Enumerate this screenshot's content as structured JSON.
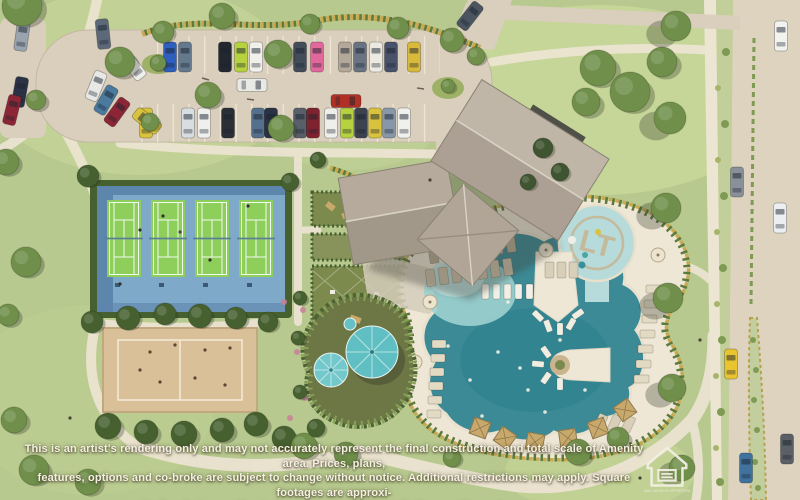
{
  "disclaimer": {
    "line1": "This is an artist's rendering only and may not accurately represent the final construction and total scale of Amenity area. Prices, plans,",
    "line2": "features, options and co-broke are subject to change without notice. Additional restrictions may apply. Square footages are approxi-",
    "line3": "mate. Rendering applies to the Lonestar at Liberty Trails amenity center only."
  },
  "logo": {
    "name": "equal-housing-opportunity-logo",
    "caption": "EQUAL HOUSING OPPORTUNITY"
  },
  "splash_pad": {
    "monogram": "LT"
  },
  "palette": {
    "grass": "#b7c98e",
    "lawn_light": "#c6d69b",
    "path": "#ebe3d0",
    "asphalt": "#d9cfbc",
    "road": "#ddd3bf",
    "sidewalk": "#ece5d2",
    "tennis_blue": "#7fa9c9",
    "tennis_blue_dark": "#5d86ad",
    "court_green": "#8ecf5c",
    "sand": "#d9c098",
    "hedge_dark": "#46602f",
    "tree_mid": "#6f8f4a",
    "roof_light": "#bcb1a2",
    "roof_dark": "#a2978a",
    "pool_deep": "#2e8694",
    "pool_shallow": "#9ed0cf",
    "splash": "#b7dada",
    "deck": "#efe7d6",
    "umbrella_teal": "#5fbfc3",
    "cabana_tan": "#c9a96b",
    "scallop_tan": "#c9aa52",
    "scallop_green": "#5d7a3c",
    "playground_surface": "#6d7745",
    "monogram_tan": "#c7b28c",
    "flower_pink": "#c97f9a",
    "text_cream": "#f4f0e2"
  },
  "scene": {
    "tennis": {
      "court_x": [
        107,
        151,
        195,
        239
      ],
      "y": 200,
      "w": 34,
      "h": 77
    },
    "cars": {
      "parking_top_row": {
        "y": 57,
        "items": [
          {
            "x": 170,
            "color": "#2f5fbe"
          },
          {
            "x": 185,
            "color": "#64788e"
          },
          {
            "x": 225,
            "color": "#23272e"
          },
          {
            "x": 241,
            "color": "#b6d23e"
          },
          {
            "x": 256,
            "color": "#f1f1ec"
          },
          {
            "x": 300,
            "color": "#454c59"
          },
          {
            "x": 317,
            "color": "#e2679b"
          },
          {
            "x": 345,
            "color": "#b3a89a"
          },
          {
            "x": 360,
            "color": "#6a7382"
          },
          {
            "x": 376,
            "color": "#ebe9e1"
          },
          {
            "x": 391,
            "color": "#49526b"
          },
          {
            "x": 414,
            "color": "#d9b93a"
          }
        ]
      },
      "parking_bottom_row": {
        "y": 123,
        "items": [
          {
            "x": 146,
            "color": "#d9c23c"
          },
          {
            "x": 188,
            "color": "#d8dde2"
          },
          {
            "x": 204,
            "color": "#eff0ee"
          },
          {
            "x": 228,
            "color": "#2b2f36"
          },
          {
            "x": 258,
            "color": "#54708c"
          },
          {
            "x": 271,
            "color": "#2c3246"
          },
          {
            "x": 300,
            "color": "#585f68"
          },
          {
            "x": 313,
            "color": "#7e222e"
          },
          {
            "x": 331,
            "color": "#eeeeea"
          },
          {
            "x": 347,
            "color": "#b6d23e"
          },
          {
            "x": 361,
            "color": "#3d434e"
          },
          {
            "x": 375,
            "color": "#d9c23c"
          },
          {
            "x": 389,
            "color": "#8897a8"
          },
          {
            "x": 404,
            "color": "#f0f0ec"
          }
        ]
      },
      "free": [
        {
          "x": 22,
          "y": 36,
          "rot": 8,
          "color": "#9aa4ae"
        },
        {
          "x": 103,
          "y": 34,
          "rot": -6,
          "color": "#5d6878"
        },
        {
          "x": 133,
          "y": 66,
          "rot": -38,
          "color": "#eff0ec"
        },
        {
          "x": 96,
          "y": 86,
          "rot": 22,
          "color": "#e8e9e6"
        },
        {
          "x": 106,
          "y": 100,
          "rot": 30,
          "color": "#4a7a9e"
        },
        {
          "x": 117,
          "y": 112,
          "rot": 36,
          "color": "#8c2636"
        },
        {
          "x": 20,
          "y": 92,
          "rot": 10,
          "color": "#2c3246"
        },
        {
          "x": 12,
          "y": 110,
          "rot": 14,
          "color": "#8c2636"
        },
        {
          "x": 147,
          "y": 121,
          "rot": -52,
          "color": "#d9c23c"
        },
        {
          "x": 252,
          "y": 85,
          "rot": 90,
          "color": "#e9eae6"
        },
        {
          "x": 346,
          "y": 101,
          "rot": 90,
          "color": "#b03026"
        },
        {
          "x": 470,
          "y": 16,
          "rot": 38,
          "color": "#4b5560"
        }
      ],
      "road": [
        {
          "x": 781,
          "y": 36,
          "color": "#f2f2ee"
        },
        {
          "x": 737,
          "y": 182,
          "color": "#8a9099"
        },
        {
          "x": 780,
          "y": 218,
          "color": "#eceff2"
        },
        {
          "x": 731,
          "y": 364,
          "color": "#e8c52e"
        },
        {
          "x": 746,
          "y": 468,
          "color": "#3f739e"
        },
        {
          "x": 787,
          "y": 449,
          "color": "#5a6066"
        }
      ]
    },
    "trees": [
      [
        22,
        6,
        20,
        "m",
        4,
        4
      ],
      [
        120,
        62,
        15,
        "m",
        4,
        4
      ],
      [
        222,
        16,
        13,
        "m",
        3,
        3
      ],
      [
        208,
        95,
        13,
        "m",
        3,
        3
      ],
      [
        36,
        100,
        10,
        "m",
        3,
        3
      ],
      [
        163,
        32,
        11,
        "m",
        2,
        2
      ],
      [
        278,
        54,
        14,
        "m",
        3,
        3
      ],
      [
        281,
        128,
        13,
        "m",
        3,
        3
      ],
      [
        150,
        122,
        9,
        "m",
        2,
        2
      ],
      [
        310,
        24,
        10,
        "m",
        2,
        2
      ],
      [
        398,
        28,
        11,
        "m",
        2,
        2
      ],
      [
        452,
        40,
        12,
        "m",
        3,
        3
      ],
      [
        476,
        56,
        9,
        "m",
        2,
        2
      ],
      [
        158,
        63,
        8,
        "m",
        2,
        2
      ],
      [
        448,
        86,
        7,
        "m",
        2,
        2
      ],
      [
        6,
        162,
        13,
        "m",
        3,
        3
      ],
      [
        26,
        262,
        15,
        "m",
        3,
        3
      ],
      [
        8,
        315,
        11,
        "m",
        3,
        3
      ],
      [
        14,
        420,
        13,
        "m",
        3,
        3
      ],
      [
        34,
        470,
        15,
        "m",
        3,
        3
      ],
      [
        88,
        482,
        13,
        "m",
        3,
        3
      ],
      [
        92,
        322,
        11,
        "d",
        2,
        2
      ],
      [
        128,
        318,
        12,
        "d",
        2,
        2
      ],
      [
        165,
        314,
        11,
        "d",
        2,
        2
      ],
      [
        200,
        316,
        12,
        "d",
        2,
        2
      ],
      [
        236,
        318,
        11,
        "d",
        2,
        2
      ],
      [
        268,
        322,
        10,
        "d",
        2,
        2
      ],
      [
        108,
        426,
        13,
        "d",
        3,
        3
      ],
      [
        146,
        432,
        12,
        "d",
        3,
        3
      ],
      [
        184,
        434,
        13,
        "d",
        3,
        3
      ],
      [
        222,
        430,
        12,
        "d",
        3,
        3
      ],
      [
        256,
        424,
        12,
        "d",
        3,
        3
      ],
      [
        284,
        438,
        12,
        "d",
        3,
        3
      ],
      [
        88,
        176,
        11,
        "d",
        2,
        2
      ],
      [
        290,
        182,
        9,
        "d",
        2,
        2
      ],
      [
        304,
        446,
        13,
        "m",
        3,
        3
      ],
      [
        346,
        454,
        12,
        "m",
        3,
        3
      ],
      [
        598,
        68,
        18,
        "m",
        4,
        4
      ],
      [
        630,
        92,
        20,
        "m",
        4,
        4
      ],
      [
        662,
        62,
        15,
        "m",
        4,
        4
      ],
      [
        586,
        102,
        14,
        "m",
        4,
        4
      ],
      [
        543,
        148,
        10,
        "x",
        2,
        2
      ],
      [
        560,
        172,
        9,
        "x",
        2,
        2
      ],
      [
        528,
        182,
        8,
        "x",
        2,
        2
      ],
      [
        676,
        26,
        15,
        "m",
        -14,
        8
      ],
      [
        670,
        118,
        16,
        "m",
        -14,
        8
      ],
      [
        666,
        208,
        15,
        "m",
        -14,
        8
      ],
      [
        668,
        298,
        15,
        "m",
        -13,
        8
      ],
      [
        672,
        388,
        14,
        "m",
        -12,
        7
      ],
      [
        682,
        468,
        13,
        "m",
        -10,
        6
      ],
      [
        578,
        452,
        13,
        "m",
        3,
        3
      ],
      [
        618,
        438,
        11,
        "m",
        3,
        3
      ],
      [
        452,
        458,
        9,
        "m",
        2,
        2
      ],
      [
        318,
        160,
        8,
        "d",
        2,
        2
      ],
      [
        300,
        298,
        7,
        "d",
        2,
        2
      ],
      [
        298,
        338,
        7,
        "d",
        2,
        2
      ],
      [
        300,
        392,
        7,
        "d",
        2,
        2
      ],
      [
        316,
        428,
        9,
        "d",
        2,
        2
      ]
    ],
    "shrub_dots": [
      [
        719,
        22,
        3
      ],
      [
        726,
        52,
        4
      ],
      [
        718,
        88,
        3
      ],
      [
        725,
        124,
        4
      ],
      [
        718,
        160,
        3
      ],
      [
        724,
        196,
        4
      ],
      [
        717,
        232,
        3
      ],
      [
        723,
        268,
        4
      ],
      [
        717,
        304,
        3
      ],
      [
        722,
        340,
        4
      ],
      [
        716,
        376,
        3
      ],
      [
        721,
        412,
        4
      ],
      [
        716,
        448,
        3
      ],
      [
        720,
        482,
        4
      ]
    ],
    "median_dots": [
      [
        753,
        340,
        3
      ],
      [
        756,
        370,
        3
      ],
      [
        754,
        400,
        3
      ],
      [
        757,
        430,
        3
      ],
      [
        755,
        462,
        3
      ],
      [
        758,
        488,
        3
      ]
    ],
    "lounger_rows": [
      {
        "x": 428,
        "y": 247,
        "count": 7,
        "dx": 13,
        "dy": 0,
        "w": 9,
        "h": 17,
        "rot": -8,
        "color": "#b9ac93"
      },
      {
        "x": 425,
        "y": 270,
        "count": 7,
        "dx": 13,
        "dy": 0,
        "w": 9,
        "h": 17,
        "rot": -8,
        "color": "#cfc3ab"
      },
      {
        "x": 482,
        "y": 284,
        "count": 5,
        "dx": 11,
        "dy": 0,
        "w": 7,
        "h": 15,
        "rot": 0,
        "color": "#f2efe6"
      },
      {
        "x": 646,
        "y": 285,
        "count": 7,
        "dx": -2,
        "dy": 15,
        "w": 15,
        "h": 8,
        "rot": 0,
        "color": "#e3dac4"
      },
      {
        "x": 432,
        "y": 340,
        "count": 6,
        "dx": -1,
        "dy": 14,
        "w": 14,
        "h": 8,
        "rot": 0,
        "color": "#e3dac4"
      },
      {
        "x": 545,
        "y": 262,
        "count": 3,
        "dx": 12,
        "dy": 0,
        "w": 9,
        "h": 16,
        "rot": 0,
        "color": "#d9cfb8"
      },
      {
        "x": 600,
        "y": 413,
        "count": 3,
        "dx": 13,
        "dy": -5,
        "w": 9,
        "h": 16,
        "rot": 25,
        "color": "#d9cfb8"
      }
    ],
    "ray_chairs": [
      [
        538,
        316,
        -45
      ],
      [
        548,
        326,
        -20
      ],
      [
        560,
        329,
        0
      ],
      [
        571,
        324,
        30
      ],
      [
        578,
        314,
        55
      ],
      [
        546,
        352,
        -35
      ],
      [
        538,
        364,
        -85
      ],
      [
        546,
        378,
        -145
      ],
      [
        560,
        384,
        180
      ]
    ],
    "cabanas": [
      [
        480,
        428,
        20
      ],
      [
        505,
        438,
        35
      ],
      [
        535,
        442,
        10
      ],
      [
        568,
        438,
        -8
      ],
      [
        598,
        428,
        -20
      ],
      [
        625,
        410,
        -35
      ]
    ],
    "deck_umbrellas": [
      [
        546,
        250
      ],
      [
        430,
        302
      ],
      [
        658,
        255
      ],
      [
        415,
        362
      ]
    ],
    "swimmers": [
      [
        470,
        380
      ],
      [
        498,
        352
      ],
      [
        528,
        390
      ],
      [
        560,
        340
      ],
      [
        508,
        302
      ],
      [
        482,
        416
      ],
      [
        545,
        412
      ],
      [
        448,
        346
      ],
      [
        520,
        368
      ],
      [
        585,
        390
      ]
    ],
    "flowers": [
      [
        303,
        310
      ],
      [
        297,
        352
      ],
      [
        305,
        398
      ],
      [
        284,
        302
      ],
      [
        290,
        418
      ]
    ],
    "court_players": [
      [
        163,
        216
      ],
      [
        120,
        284
      ],
      [
        248,
        206
      ],
      [
        210,
        260
      ],
      [
        140,
        230
      ]
    ],
    "sand_players": [
      [
        150,
        352
      ],
      [
        175,
        345
      ],
      [
        205,
        350
      ],
      [
        230,
        348
      ],
      [
        160,
        382
      ],
      [
        195,
        378
      ],
      [
        225,
        385
      ],
      [
        140,
        370
      ]
    ],
    "pedestrians": [
      [
        180,
        232
      ],
      [
        70,
        418
      ],
      [
        640,
        478
      ],
      [
        700,
        340
      ],
      [
        430,
        180
      ]
    ]
  }
}
